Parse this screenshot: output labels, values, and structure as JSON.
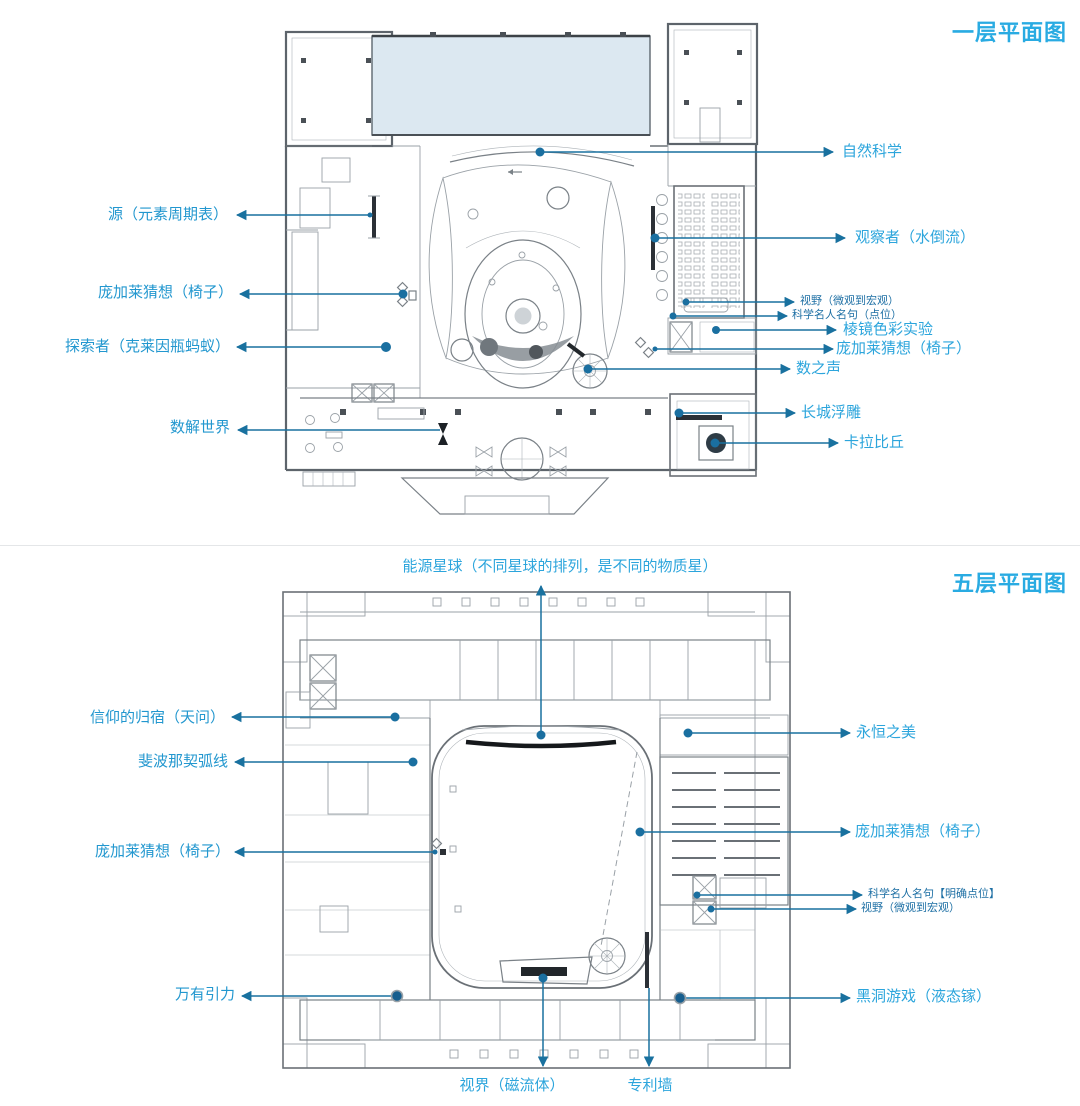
{
  "document": {
    "type": "museum-floor-plan-annotation-sheet"
  },
  "colors": {
    "label_primary": "#2CA5DC",
    "label_small": "#1D6FA4",
    "title_accent": "#29ABE2",
    "leader_line": "#19719F",
    "pool_fill": "#DCE8F1",
    "plan_linework": "#7A8187"
  },
  "floor1": {
    "title": "一层平面图",
    "labels": {
      "yuan": "源（元素周期表）",
      "pang_left": "庞加莱猜想（椅子）",
      "tansuozhe": "探索者（克莱因瓶蚂蚁）",
      "shujie": "数解世界",
      "ziran": "自然科学",
      "guanchazhe": "观察者（水倒流）",
      "shiye": "视野（微观到宏观）",
      "mingju": "科学名人名句（点位）",
      "lengjing": "棱镜色彩实验",
      "pang_right": "庞加莱猜想（椅子）",
      "shuzhisheng": "数之声",
      "changcheng": "长城浮雕",
      "kalabiqiu": "卡拉比丘"
    }
  },
  "floor5": {
    "title": "五层平面图",
    "labels": {
      "nengyuan": "能源星球（不同星球的排列，是不同的物质星）",
      "xinyang": "信仰的归宿（天问）",
      "feibo": "斐波那契弧线",
      "pang_left": "庞加莱猜想（椅子）",
      "wanyou": "万有引力",
      "yongheng": "永恒之美",
      "pang_right": "庞加莱猜想（椅子）",
      "mingju": "科学名人名句【明确点位】",
      "shiye": "视野（微观到宏观）",
      "heidong": "黑洞游戏（液态镓）",
      "shijie": "视界（磁流体）",
      "zhuanli": "专利墙"
    }
  }
}
